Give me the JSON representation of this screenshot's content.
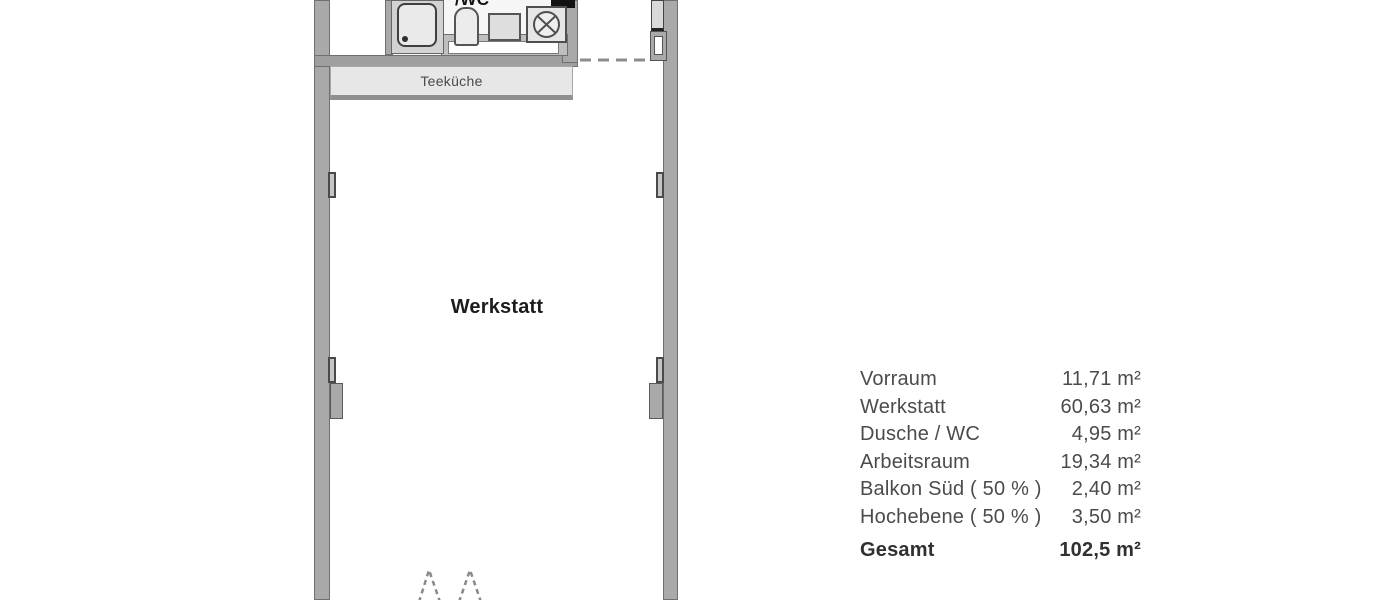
{
  "floor_plan": {
    "werkstatt_label": "Werkstatt",
    "teekueche_label": "Teeküche",
    "wc_label_fragment": "/WC"
  },
  "area_table": {
    "rows": [
      {
        "label": "Vorraum",
        "value": "11,71 m²"
      },
      {
        "label": "Werkstatt",
        "value": "60,63 m²"
      },
      {
        "label": "Dusche / WC",
        "value": "4,95 m²"
      },
      {
        "label": "Arbeitsraum",
        "value": "19,34 m²"
      },
      {
        "label": "Balkon Süd ( 50 % )",
        "value": "2,40 m²"
      },
      {
        "label": "Hochebene ( 50 % )",
        "value": "3,50 m²"
      }
    ],
    "total": {
      "label": "Gesamt",
      "value": "102,5 m²"
    }
  },
  "palette": {
    "wall_gray": "#a9a9a9",
    "fixture_gray": "#e7e7e7",
    "counter_white": "#fefefe",
    "dashed_gray": "#8c8c8c",
    "table_text": "#4b4b4b"
  }
}
